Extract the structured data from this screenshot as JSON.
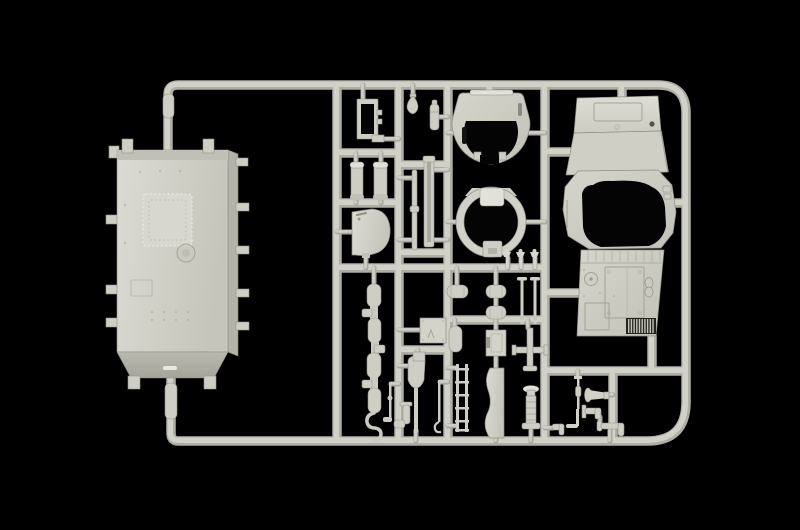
{
  "scene": {
    "description": "Photograph of an injection-moulded light-grey plastic model kit sprue (parts frame) for an armoured vehicle, lit against a black background",
    "background": "pure black studio backdrop",
    "material": "matte light-grey styrene plastic",
    "text_visible": "none"
  },
  "colors": {
    "bg": "#000000",
    "plastic": "#d4d3ca",
    "plastic-hi": "#e2e1d9",
    "plastic-lo": "#b4b3aa",
    "runner": "#d2d1c8",
    "edge": "#8f8e85",
    "hole": "#040404",
    "slot": "#14130f"
  },
  "parts": [
    {
      "name": "hull-tub",
      "label": "Large rectangular hull tub with riveted hatch panel and side tabs"
    },
    {
      "name": "sprue-frame",
      "label": "Rectangular runner frame with interior cross runners"
    },
    {
      "name": "hatch-frame",
      "label": "Small open rectangular hatch frame"
    },
    {
      "name": "stowage-cylinders",
      "label": "Two capped cylindrical drums"
    },
    {
      "name": "hatch-cover",
      "label": "D-shaped hatch cover with grab handle"
    },
    {
      "name": "bulb-fitting",
      "label": "Small teardrop bulb fitting"
    },
    {
      "name": "muffler",
      "label": "Small stepped cylinder"
    },
    {
      "name": "rod-strips",
      "label": "Two long rod and channel strips"
    },
    {
      "name": "gun-shield",
      "label": "Horseshoe-shaped gun shield with slot"
    },
    {
      "name": "hatch-ring",
      "label": "Circular hatch ring with top and bottom tabs"
    },
    {
      "name": "figure-sprigs",
      "label": "Three tiny sprue sprigs"
    },
    {
      "name": "superstructure",
      "label": "Armoured cab roof with octagonal turret opening"
    },
    {
      "name": "engine-deck",
      "label": "Engine deck panel with hinge strip and louvred grille"
    },
    {
      "name": "stowage-pills",
      "label": "Small oval stowage cases"
    },
    {
      "name": "tool-box",
      "label": "Rectangular stowage box"
    },
    {
      "name": "shovel",
      "label": "Shovel with short handle"
    },
    {
      "name": "ladder",
      "label": "Short ladder section"
    },
    {
      "name": "mudguard",
      "label": "Curved mudguard panel"
    },
    {
      "name": "axle-cross",
      "label": "Cross-shaped axle piece"
    },
    {
      "name": "jack",
      "label": "Ribbed screw jack"
    },
    {
      "name": "fitting-chain",
      "label": "Vertical chain of capsule fittings and elbows"
    },
    {
      "name": "horn",
      "label": "Horn funnel fitting"
    },
    {
      "name": "pipe-fittings",
      "label": "Small elbow and tee pipe fittings"
    }
  ]
}
